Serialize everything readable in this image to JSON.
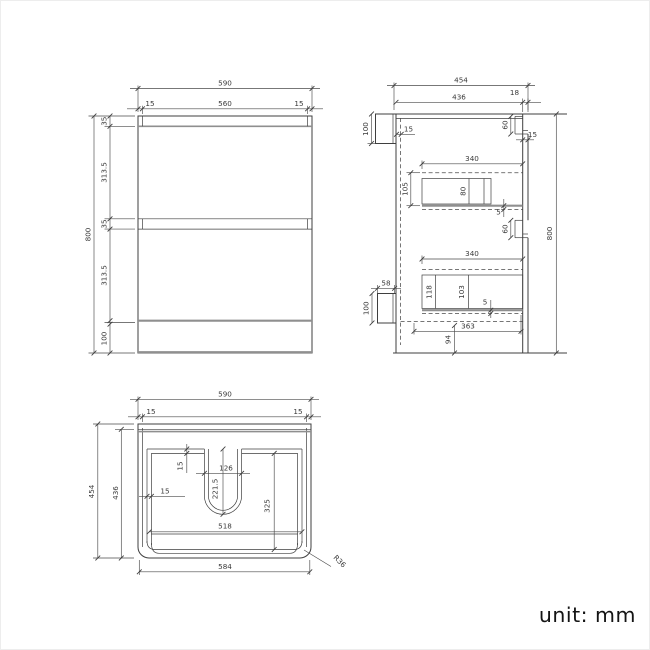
{
  "views": {
    "front": {
      "dims": {
        "overall_width": "590",
        "inset_left": "15",
        "inner_width": "560",
        "inset_right": "15",
        "overall_height": "800",
        "top_panel": "35",
        "drawer_upper": "313.5",
        "gap": "35",
        "drawer_lower": "313.5",
        "kick": "100"
      }
    },
    "side": {
      "dims": {
        "overall_depth": "454",
        "carcass_depth": "436",
        "front_thickness": "18",
        "rail_top_height": "100",
        "back_panel": "15",
        "notch_top": "60",
        "front_gap": "15",
        "drawer_top_depth": "340",
        "drawer_top_height": "105",
        "drawer_top_inner": "80",
        "clearance_top": "5",
        "notch_mid": "60",
        "drawer_bottom_depth": "340",
        "rail_bottom_width": "58",
        "drawer_bottom_side": "118",
        "drawer_bottom_inner": "103",
        "clearance_bottom": "5",
        "rail_bottom_height": "100",
        "base_depth": "363",
        "base_offset": "94",
        "overall_height": "800"
      }
    },
    "plan": {
      "dims": {
        "overall_width": "590",
        "inset_left": "15",
        "inset_right": "15",
        "overall_depth": "454",
        "inner_depth": "436",
        "wall_back": "15",
        "cutout_width": "126",
        "cutout_depth": "221.5",
        "cavity_depth": "325",
        "wall_left": "15",
        "cavity_width": "518",
        "base_width": "584",
        "corner_radius": "R36"
      }
    }
  },
  "footer": {
    "unit_label": "unit: mm"
  },
  "colors": {
    "line": "#3f3f3f",
    "panel_line": "#8f8f8f",
    "text": "#3a3a3a",
    "background": "#ffffff"
  }
}
